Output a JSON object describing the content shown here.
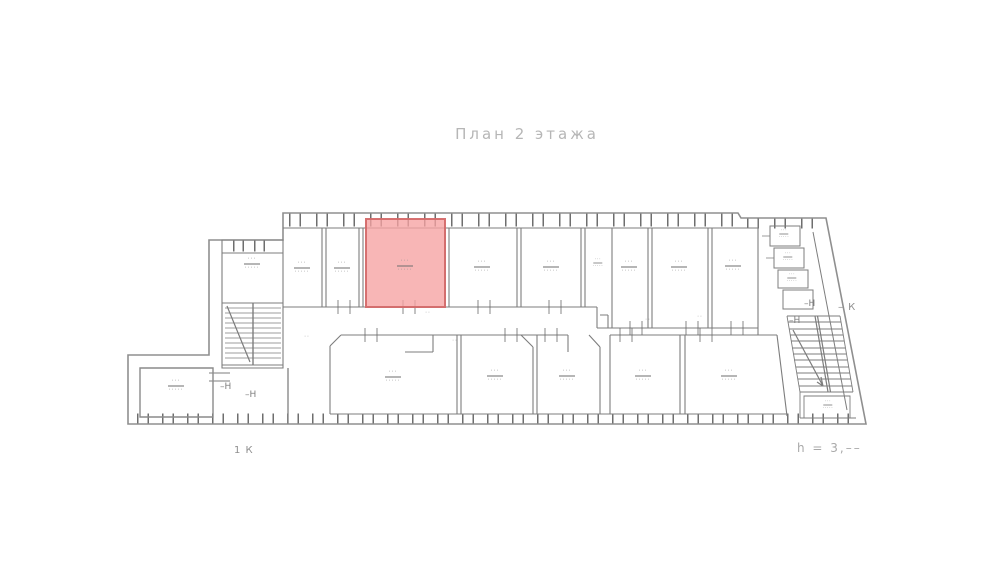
{
  "title": "План 2 этажа",
  "notes": {
    "height_note": "h = 3,––",
    "k_left": "1 К",
    "k_right": "– К"
  },
  "marks": {
    "n1": "–Н",
    "n2": "–Н",
    "n3": "–Н",
    "n4": "–Н"
  },
  "room_label": {
    "number": "···",
    "area": "·····"
  },
  "smudge": "··",
  "colors": {
    "wall": "#8a8a8a",
    "highlight_fill": "#f6a2a2",
    "highlight_border": "#d46a6a",
    "faint_text": "#b6b6b6"
  }
}
